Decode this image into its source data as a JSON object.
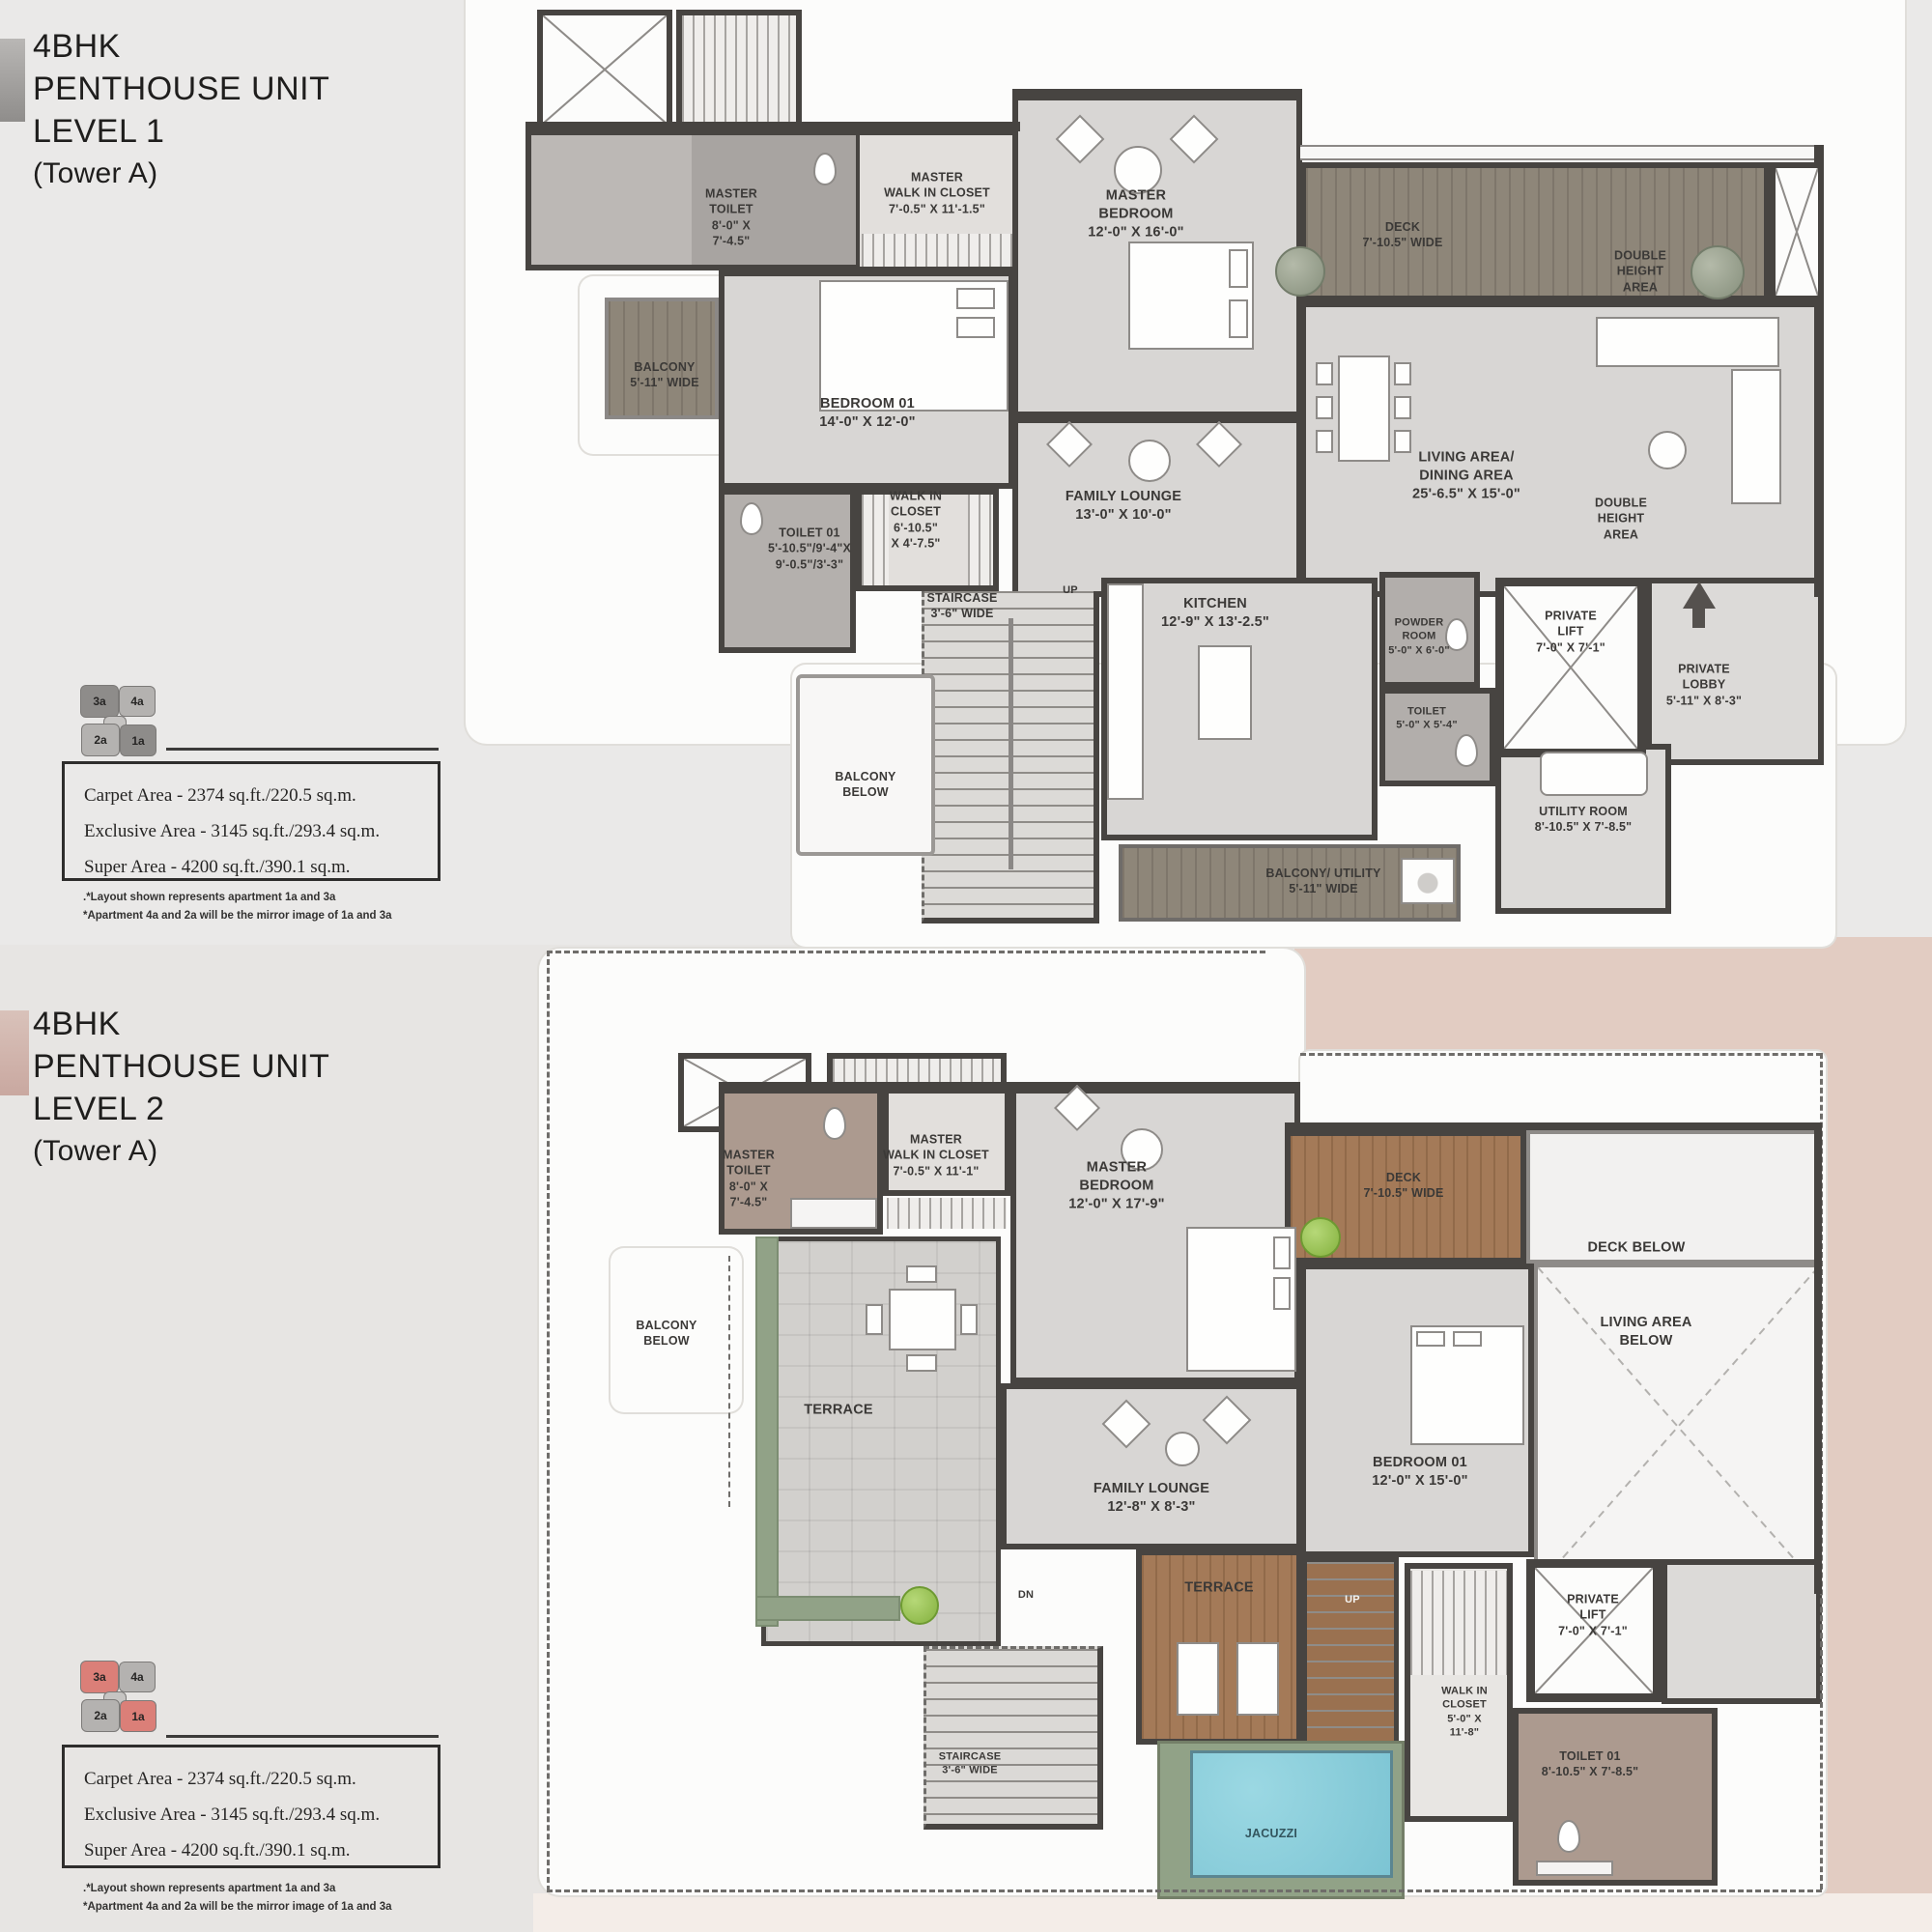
{
  "doc": {
    "type": "floor-plan-brochure"
  },
  "colors": {
    "wall": "#474441",
    "wood_level1": "#8e8679",
    "wood_level2": "#a47a58",
    "planter_green": "#91a287",
    "jacuzzi_blue": "#85ccd9",
    "pink_band": "#e2ccc2",
    "keyplan_highlight_level1": "#8e8c8a",
    "keyplan_highlight_level2": "#db7f78",
    "keyplan_muted": "#b4b2b0"
  },
  "level1": {
    "title_lines": [
      "4BHK",
      "PENTHOUSE UNIT",
      "LEVEL 1"
    ],
    "subtitle": "(Tower A)",
    "keyplan": {
      "u3a": "3a",
      "u4a": "4a",
      "u2a": "2a",
      "u1a": "1a"
    },
    "area_lines": [
      "Carpet Area - 2374 sq.ft./220.5 sq.m.",
      "Exclusive Area - 3145 sq.ft./293.4 sq.m.",
      "Super Area - 4200 sq.ft./390.1 sq.m."
    ],
    "note_lines": [
      ".*Layout shown represents apartment 1a and 3a",
      "*Apartment 4a and 2a will be the mirror image of 1a and 3a"
    ],
    "rooms": {
      "master_toilet": {
        "lines": [
          "MASTER",
          "TOILET",
          "8'-0\" X",
          "7'-4.5\""
        ]
      },
      "master_wic": {
        "lines": [
          "MASTER",
          "WALK IN CLOSET",
          "7'-0.5\" X 11'-1.5\""
        ]
      },
      "master_bedroom": {
        "lines": [
          "MASTER",
          "BEDROOM",
          "12'-0\" X 16'-0\""
        ]
      },
      "deck": {
        "lines": [
          "DECK",
          "7'-10.5\" WIDE"
        ]
      },
      "double_height_top": {
        "lines": [
          "DOUBLE",
          "HEIGHT",
          "AREA"
        ]
      },
      "balcony": {
        "lines": [
          "BALCONY",
          "5'-11\" WIDE"
        ]
      },
      "bedroom_01": {
        "lines": [
          "BEDROOM 01",
          "14'-0\" X 12'-0\""
        ]
      },
      "toilet_01": {
        "lines": [
          "TOILET 01",
          "5'-10.5\"/9'-4\"X",
          "9'-0.5\"/3'-3\""
        ]
      },
      "walk_in_closet": {
        "lines": [
          "WALK IN",
          "CLOSET",
          "6'-10.5\"",
          "X 4'-7.5\""
        ]
      },
      "family_lounge": {
        "lines": [
          "FAMILY LOUNGE",
          "13'-0\" X 10'-0\""
        ]
      },
      "living_dining": {
        "lines": [
          "LIVING AREA/",
          "DINING AREA",
          "25'-6.5\" X 15'-0\""
        ]
      },
      "double_height_mid": {
        "lines": [
          "DOUBLE",
          "HEIGHT",
          "AREA"
        ]
      },
      "staircase": {
        "lines": [
          "STAIRCASE",
          "3'-6\" WIDE"
        ]
      },
      "up_label": "UP",
      "kitchen": {
        "lines": [
          "KITCHEN",
          "12'-9\" X 13'-2.5\""
        ]
      },
      "powder_room": {
        "lines": [
          "POWDER",
          "ROOM",
          "5'-0\" X 6'-0\""
        ]
      },
      "toilet": {
        "lines": [
          "TOILET",
          "5'-0\" X 5'-4\""
        ]
      },
      "private_lift": {
        "lines": [
          "PRIVATE",
          "LIFT",
          "7'-0\" X 7'-1\""
        ]
      },
      "private_lobby": {
        "lines": [
          "PRIVATE",
          "LOBBY",
          "5'-11\" X 8'-3\""
        ]
      },
      "utility_room": {
        "lines": [
          "UTILITY ROOM",
          "8'-10.5\" X 7'-8.5\""
        ]
      },
      "balcony_below": {
        "lines": [
          "BALCONY",
          "BELOW"
        ]
      },
      "balcony_utility": {
        "lines": [
          "BALCONY/ UTILITY",
          "5'-11\" WIDE"
        ]
      }
    }
  },
  "level2": {
    "title_lines": [
      "4BHK",
      "PENTHOUSE UNIT",
      "LEVEL 2"
    ],
    "subtitle": "(Tower A)",
    "keyplan": {
      "u3a": "3a",
      "u4a": "4a",
      "u2a": "2a",
      "u1a": "1a"
    },
    "area_lines": [
      "Carpet Area - 2374 sq.ft./220.5 sq.m.",
      "Exclusive Area - 3145 sq.ft./293.4 sq.m.",
      "Super Area - 4200 sq.ft./390.1 sq.m."
    ],
    "note_lines": [
      ".*Layout shown represents apartment 1a and 3a",
      "*Apartment 4a and 2a will be the mirror image of 1a and 3a"
    ],
    "rooms": {
      "master_toilet": {
        "lines": [
          "MASTER",
          "TOILET",
          "8'-0\" X",
          "7'-4.5\""
        ]
      },
      "master_wic": {
        "lines": [
          "MASTER",
          "WALK IN CLOSET",
          "7'-0.5\" X 11'-1\""
        ]
      },
      "master_bedroom": {
        "lines": [
          "MASTER",
          "BEDROOM",
          "12'-0\" X 17'-9\""
        ]
      },
      "deck": {
        "lines": [
          "DECK",
          "7'-10.5\" WIDE"
        ]
      },
      "deck_below": "DECK BELOW",
      "living_area_below": {
        "lines": [
          "LIVING AREA",
          "BELOW"
        ]
      },
      "balcony_below": {
        "lines": [
          "BALCONY",
          "BELOW"
        ]
      },
      "terrace_left": "TERRACE",
      "family_lounge": {
        "lines": [
          "FAMILY LOUNGE",
          "12'-8\" X 8'-3\""
        ]
      },
      "bedroom_01": {
        "lines": [
          "BEDROOM 01",
          "12'-0\" X 15'-0\""
        ]
      },
      "terrace_right": "TERRACE",
      "dn_label": "DN",
      "up_label": "UP",
      "staircase": {
        "lines": [
          "STAIRCASE",
          "3'-6\" WIDE"
        ]
      },
      "walk_in_closet": {
        "lines": [
          "WALK IN",
          "CLOSET",
          "5'-0\" X",
          "11'-8\""
        ]
      },
      "toilet_01": {
        "lines": [
          "TOILET 01",
          "8'-10.5\" X 7'-8.5\""
        ]
      },
      "private_lift": {
        "lines": [
          "PRIVATE",
          "LIFT",
          "7'-0\" X 7'-1\""
        ]
      },
      "jacuzzi": "JACUZZI"
    }
  }
}
